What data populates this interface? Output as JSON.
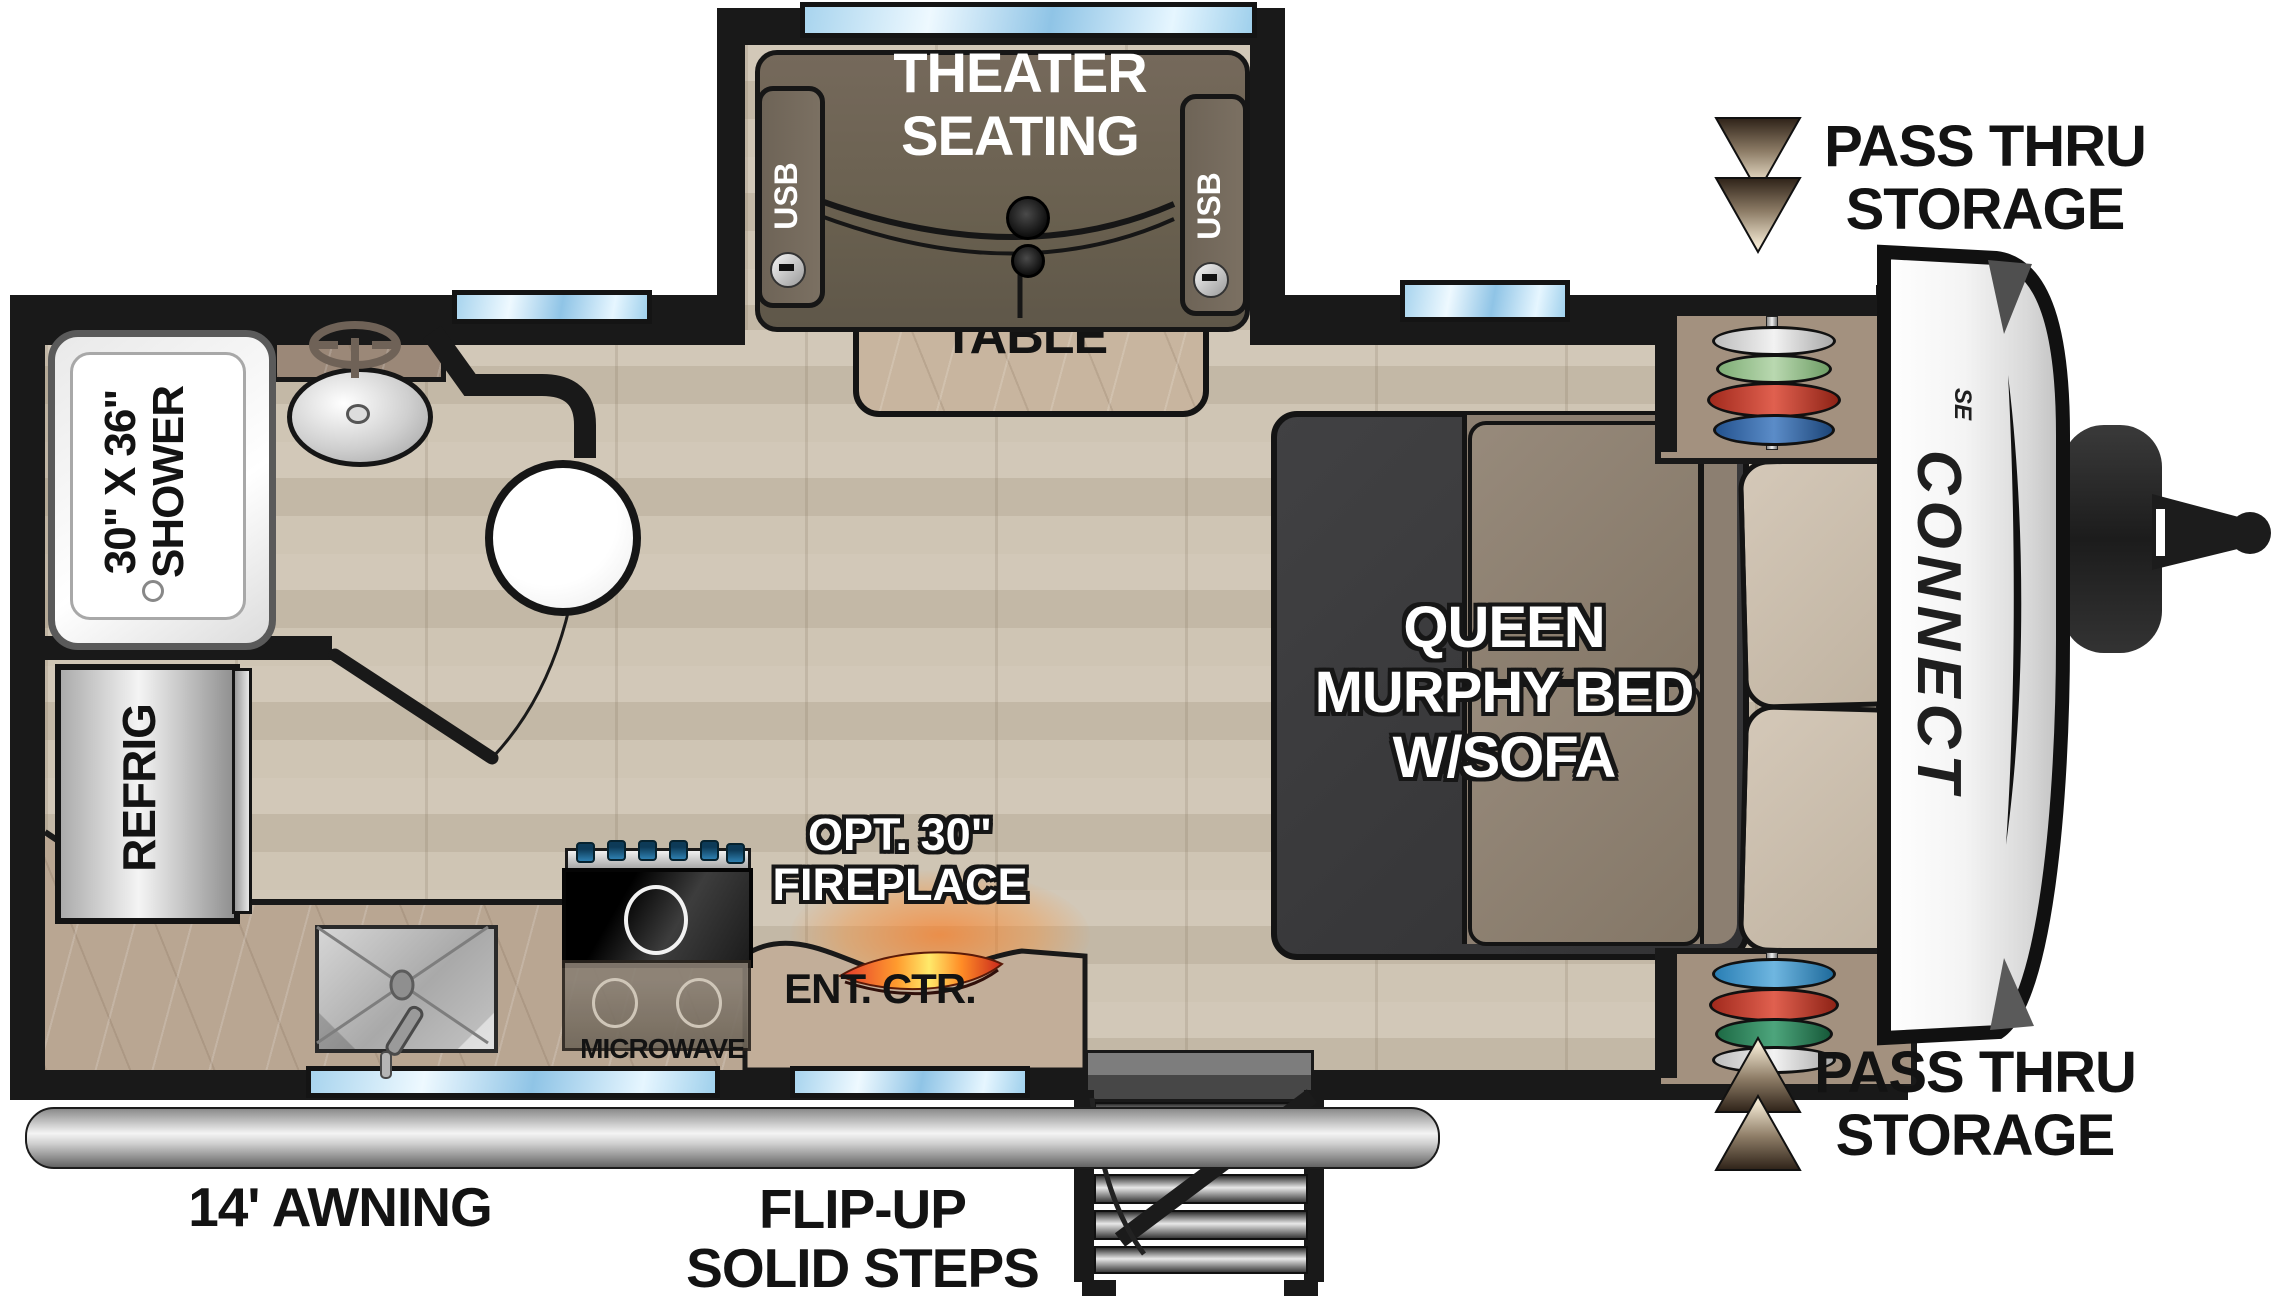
{
  "title": "Connect SE travel trailer floor plan",
  "brand": {
    "name": "CONNECT",
    "trim": "SE"
  },
  "labels": {
    "theater_seating": "THEATER\nSEATING",
    "usb": "USB",
    "table": "TABLE",
    "pass_thru_storage": "PASS THRU\nSTORAGE",
    "shower": "30\" X 36\"\nSHOWER",
    "refrig": "REFRIG",
    "queen_bed": "QUEEN\nMURPHY BED\nW/SOFA",
    "microwave": "MICROWAVE",
    "ent_ctr": "ENT. CTR.",
    "fireplace": "OPT. 30\"\nFIREPLACE",
    "awning": "14' AWNING",
    "steps": "FLIP-UP\nSOLID STEPS"
  },
  "colors": {
    "wall": "#191919",
    "floor_wood": "#ccc2b2",
    "counter": "#b9a692",
    "window_glass": "#a8d4ee",
    "seat_dark_taupe": "#6e6457",
    "bed_charcoal": "#3b3b3d",
    "sofa_tan": "#8c7f71",
    "pillow_tan": "#c9bcab",
    "flame_orange": "#ff9b2e",
    "clothes_red": "#c23a2b",
    "clothes_blue": "#2f6fb5",
    "clothes_green": "#8fbf85",
    "metal_silver": "#d8d8d8"
  }
}
